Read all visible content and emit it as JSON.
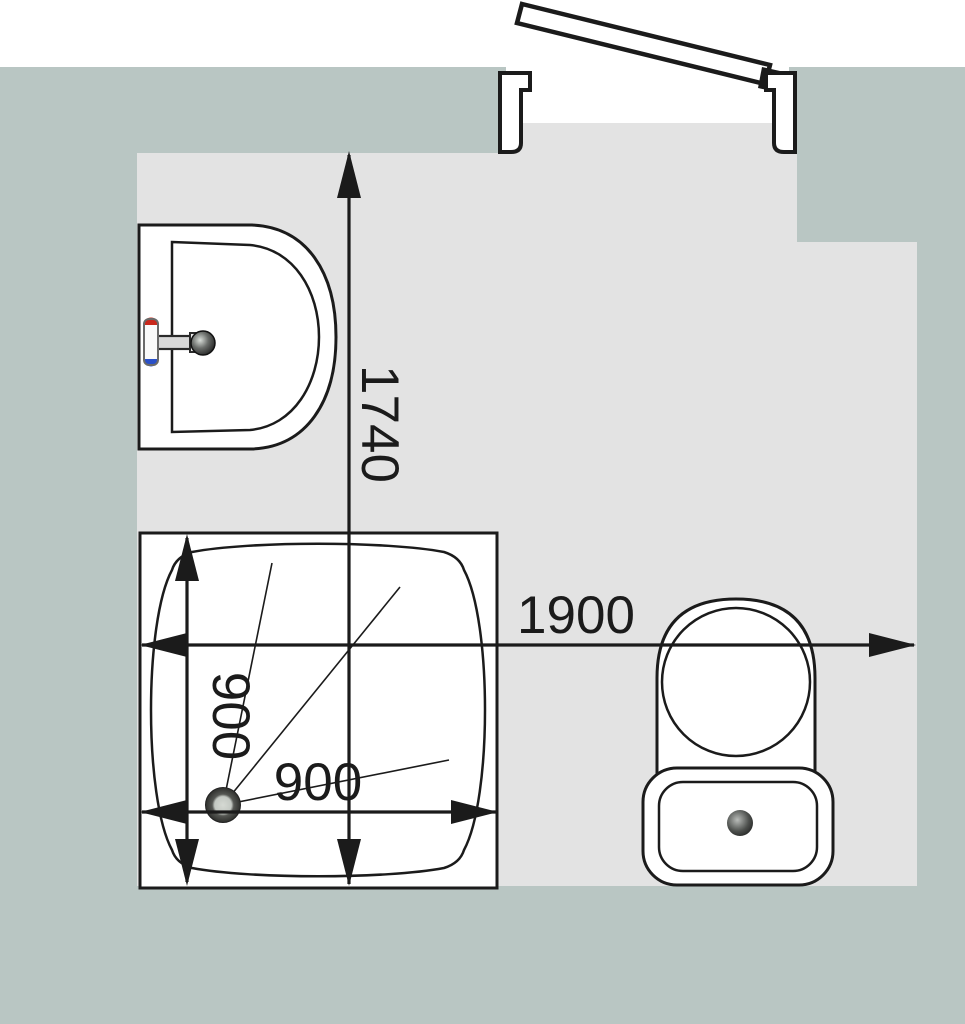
{
  "drawing": {
    "title": "bathroom-floor-plan",
    "dimensions": {
      "room_depth_mm": "1740",
      "room_width_mm": "1900",
      "shower_width_mm": "900",
      "shower_depth_mm": "900"
    },
    "fixtures": [
      {
        "name": "door",
        "state": "open"
      },
      {
        "name": "washbasin",
        "features": [
          "hot-tap",
          "cold-tap",
          "spout",
          "drain-knob"
        ]
      },
      {
        "name": "shower-tray",
        "features": [
          "drain",
          "slope-lines"
        ]
      },
      {
        "name": "toilet",
        "features": [
          "seat",
          "cistern",
          "flush-button"
        ]
      }
    ],
    "colors": {
      "wall": "#b9c6c3",
      "floor": "#e3e3e3",
      "line": "#1b1b1b",
      "fixture_fill": "#ffffff",
      "hot_tap": "#c9281c",
      "cold_tap": "#2a50c8"
    }
  }
}
